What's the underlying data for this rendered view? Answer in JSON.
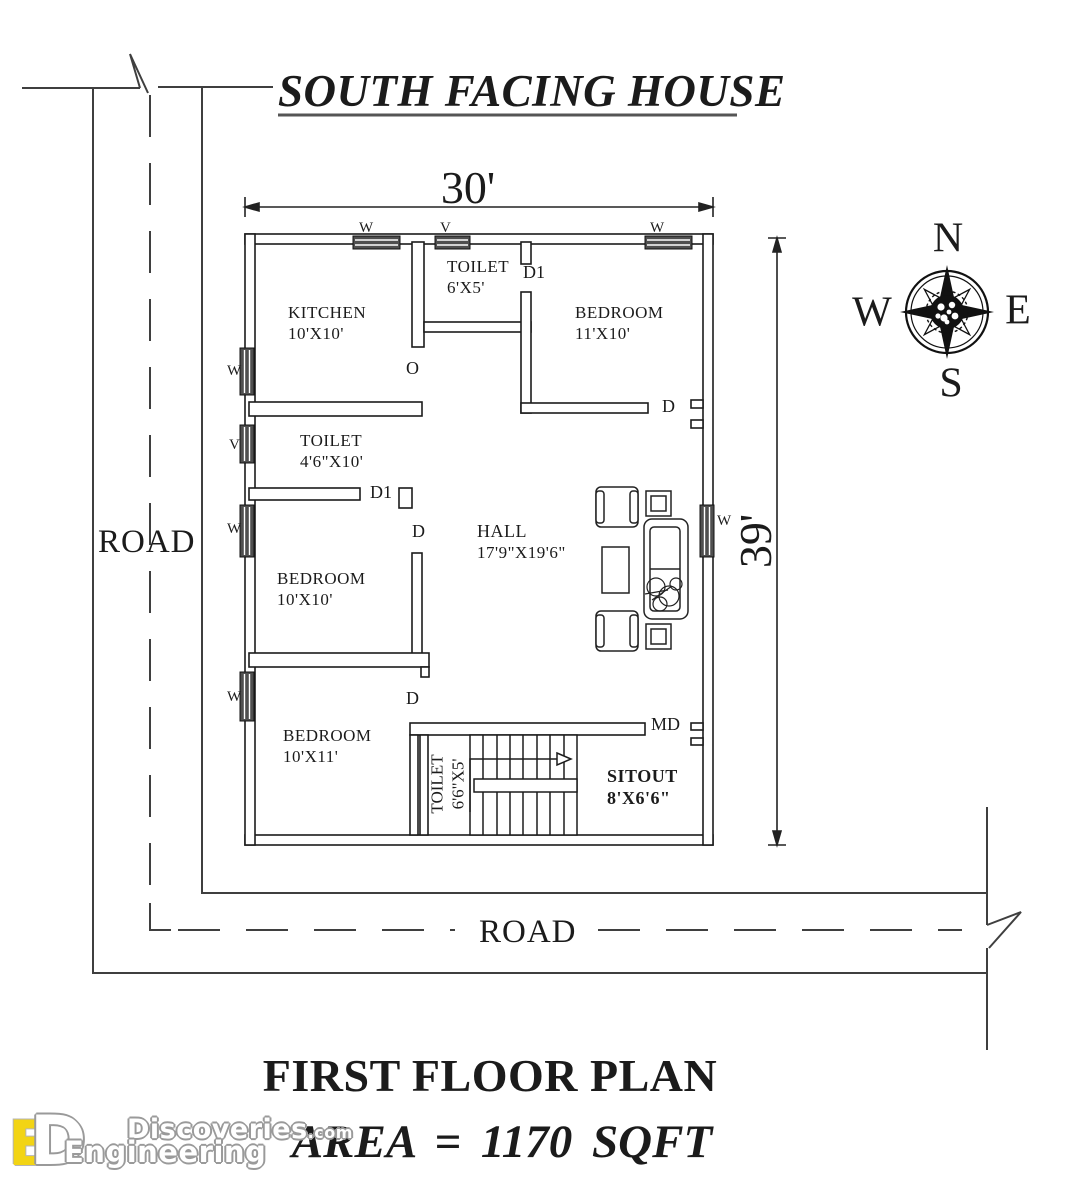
{
  "title": "SOUTH FACING HOUSE",
  "dimensions": {
    "width": "30'",
    "depth": "39'"
  },
  "compass": {
    "north": "N",
    "east": "E",
    "south": "S",
    "west": "W"
  },
  "roads": {
    "left": "ROAD",
    "bottom": "ROAD"
  },
  "rooms": {
    "kitchen": {
      "name": "KITCHEN",
      "size": "10'X10'"
    },
    "toilet_top": {
      "name": "TOILET",
      "size": "6'X5'"
    },
    "bedroom_top": {
      "name": "BEDROOM",
      "size": "11'X10'"
    },
    "toilet_left": {
      "name": "TOILET",
      "size": "4'6\"X10'"
    },
    "bedroom_middle": {
      "name": "BEDROOM",
      "size": "10'X10'"
    },
    "hall": {
      "name": "HALL",
      "size": "17'9\"X19'6\""
    },
    "bedroom_bottom": {
      "name": "BEDROOM",
      "size": "10'X11'"
    },
    "toilet_bottom": {
      "name": "TOILET",
      "size": "6'6\"X5'"
    },
    "sitout": {
      "name": "SITOUT",
      "size": "8'X6'6\""
    }
  },
  "openings": {
    "window": "W",
    "ventilator": "V",
    "door": "D",
    "toilet_door": "D1",
    "main_door": "MD",
    "opening": "O"
  },
  "footer": {
    "plan_name": "FIRST FLOOR PLAN",
    "area": "AREA = 1170 SQFT"
  },
  "logo": {
    "letter_e": "E",
    "letter_d": "D",
    "brand_top": "Discoveries",
    "brand_top_suffix": ".com",
    "brand_bottom": "Engineering"
  }
}
